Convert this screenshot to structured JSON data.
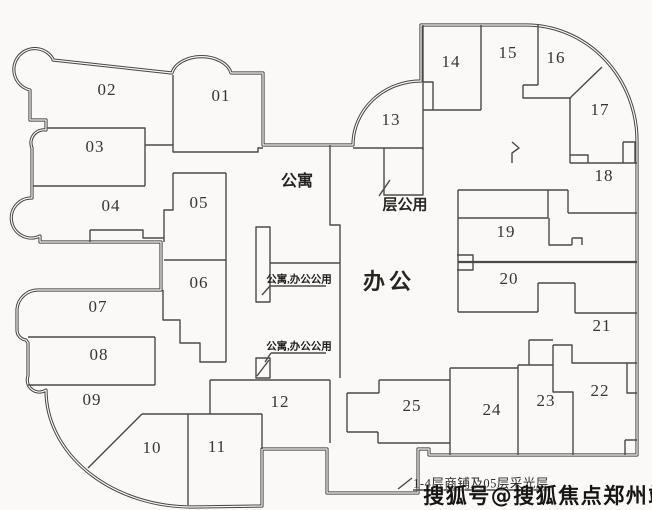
{
  "plan_type_hint": "floor-plan",
  "colors": {
    "background": "#faf9f7",
    "wall": "#454440",
    "label_text": "#36352f",
    "watermark_text": "#161513"
  },
  "units": [
    {
      "id": "01",
      "label": "01"
    },
    {
      "id": "02",
      "label": "02"
    },
    {
      "id": "03",
      "label": "03"
    },
    {
      "id": "04",
      "label": "04"
    },
    {
      "id": "05",
      "label": "05"
    },
    {
      "id": "06",
      "label": "06"
    },
    {
      "id": "07",
      "label": "07"
    },
    {
      "id": "08",
      "label": "08"
    },
    {
      "id": "09",
      "label": "09"
    },
    {
      "id": "10",
      "label": "10"
    },
    {
      "id": "11",
      "label": "11"
    },
    {
      "id": "12",
      "label": "12"
    },
    {
      "id": "13",
      "label": "13"
    },
    {
      "id": "14",
      "label": "14"
    },
    {
      "id": "15",
      "label": "15"
    },
    {
      "id": "16",
      "label": "16"
    },
    {
      "id": "17",
      "label": "17"
    },
    {
      "id": "18",
      "label": "18"
    },
    {
      "id": "19",
      "label": "19"
    },
    {
      "id": "20",
      "label": "20"
    },
    {
      "id": "21",
      "label": "21"
    },
    {
      "id": "22",
      "label": "22"
    },
    {
      "id": "23",
      "label": "23"
    },
    {
      "id": "24",
      "label": "24"
    },
    {
      "id": "25",
      "label": "25"
    }
  ],
  "zones": [
    {
      "id": "apartment",
      "label": "公寓"
    },
    {
      "id": "floor-common",
      "label": "层公用"
    },
    {
      "id": "office",
      "label": "办公"
    }
  ],
  "callouts": [
    {
      "text": "公寓,办公公用"
    },
    {
      "text": "公寓,办公公用"
    }
  ],
  "note": {
    "text": "1-4层商铺及05层采光层"
  },
  "watermark": {
    "text": "搜狐号@搜狐焦点郑州站"
  }
}
